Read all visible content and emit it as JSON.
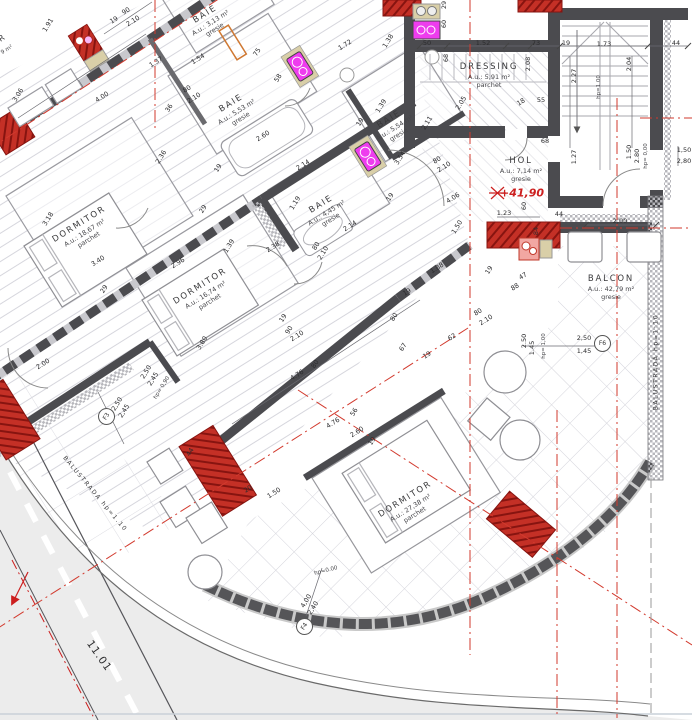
{
  "colors": {
    "wall": "#4b4b4f",
    "pier_red": "#c43026",
    "fixture_magenta": "#ee3cee",
    "fixture_beige": "#d9cfa8",
    "annotation_red": "#cc1f1f",
    "hatch": "#d6d6dd"
  },
  "rooms": [
    {
      "name": "DORMITOR",
      "area": "A.u.: 18,67 m²",
      "floor": "parchet",
      "x": 84,
      "y": 232,
      "r": -32
    },
    {
      "name": "DORMITOR",
      "area": "A.u.: 16,74 m²",
      "floor": "parchet",
      "x": 205,
      "y": 294,
      "r": -32
    },
    {
      "name": "DORMITOR",
      "area": "A.u.: 27,38 m²",
      "floor": "parchet",
      "x": 410,
      "y": 507,
      "r": -32
    },
    {
      "name": "BAIE",
      "area": "A.u.: 3,13 m²",
      "floor": "gresie",
      "x": 210,
      "y": 22,
      "r": -32
    },
    {
      "name": "BAIE",
      "area": "A.u.: 5,53 m²",
      "floor": "gresie",
      "x": 236,
      "y": 111,
      "r": -32
    },
    {
      "name": "BAIE",
      "area": "A.u.: 5,54 m²",
      "floor": "gresie",
      "x": 394,
      "y": 127,
      "r": -32
    },
    {
      "name": "BAIE",
      "area": "A.u.: 4,45 m²",
      "floor": "gresie",
      "x": 326,
      "y": 212,
      "r": -32
    },
    {
      "name": "DRESSING",
      "area": "A.u.: 5,91 m²",
      "floor": "parchet",
      "x": 489,
      "y": 76,
      "r": 0
    },
    {
      "name": "HOL",
      "area": "A.u.: 7,14 m²",
      "floor": "gresie",
      "x": 521,
      "y": 170,
      "r": 0
    },
    {
      "name": "BALCON",
      "area": "A.u.: 42,79 m²",
      "floor": "gresie",
      "x": 611,
      "y": 288,
      "r": 0
    }
  ],
  "window_tags": [
    {
      "id": "F3",
      "x": 106,
      "y": 416,
      "r": -58
    },
    {
      "id": "F4",
      "x": 304,
      "y": 626,
      "r": -58
    },
    {
      "id": "F6",
      "x": 602,
      "y": 343,
      "r": 0
    }
  ],
  "labels": [
    {
      "t": "1.91",
      "x": 48,
      "y": 25,
      "r": -58
    },
    {
      "t": "19",
      "x": 114,
      "y": 20,
      "r": -32
    },
    {
      "t": "90",
      "x": 126,
      "y": 11,
      "r": -32
    },
    {
      "t": "2.10",
      "x": 133,
      "y": 21,
      "r": -32
    },
    {
      "t": "1.37",
      "x": 156,
      "y": 62,
      "r": -32
    },
    {
      "t": "3.06",
      "x": 18,
      "y": 95,
      "r": -58
    },
    {
      "t": "4.00",
      "x": 102,
      "y": 97,
      "r": -32
    },
    {
      "t": "80",
      "x": 187,
      "y": 89,
      "r": -32
    },
    {
      "t": "2.10",
      "x": 194,
      "y": 98,
      "r": -32
    },
    {
      "t": "36",
      "x": 169,
      "y": 108,
      "r": -58
    },
    {
      "t": "2.36",
      "x": 161,
      "y": 157,
      "r": -58
    },
    {
      "t": "19",
      "x": 218,
      "y": 168,
      "r": -58
    },
    {
      "t": "29",
      "x": 203,
      "y": 209,
      "r": -58
    },
    {
      "t": "3.18",
      "x": 48,
      "y": 219,
      "r": -58
    },
    {
      "t": "3.40",
      "x": 98,
      "y": 261,
      "r": -32
    },
    {
      "t": "2.96",
      "x": 178,
      "y": 263,
      "r": -32
    },
    {
      "t": "1.39",
      "x": 229,
      "y": 246,
      "r": -58
    },
    {
      "t": "29",
      "x": 104,
      "y": 289,
      "r": -58
    },
    {
      "t": "2.00",
      "x": 43,
      "y": 364,
      "r": -32
    },
    {
      "t": "3.80",
      "x": 202,
      "y": 343,
      "r": -58
    },
    {
      "t": "1.54",
      "x": 198,
      "y": 59,
      "r": -32
    },
    {
      "t": "75",
      "x": 257,
      "y": 52,
      "r": -58
    },
    {
      "t": "58",
      "x": 278,
      "y": 78,
      "r": -58
    },
    {
      "t": "2.60",
      "x": 263,
      "y": 136,
      "r": -32
    },
    {
      "t": "1.72",
      "x": 345,
      "y": 45,
      "r": -32
    },
    {
      "t": "1.38",
      "x": 388,
      "y": 41,
      "r": -58
    },
    {
      "t": "1.39",
      "x": 381,
      "y": 106,
      "r": -58
    },
    {
      "t": "19",
      "x": 360,
      "y": 122,
      "r": -58
    },
    {
      "t": "2.14",
      "x": 303,
      "y": 165,
      "r": -32
    },
    {
      "t": "2.14",
      "x": 350,
      "y": 226,
      "r": -32
    },
    {
      "t": "2.38",
      "x": 273,
      "y": 247,
      "r": -32
    },
    {
      "t": "80",
      "x": 316,
      "y": 246,
      "r": -58
    },
    {
      "t": "2.10",
      "x": 323,
      "y": 253,
      "r": -58
    },
    {
      "t": "19",
      "x": 283,
      "y": 318,
      "r": -58
    },
    {
      "t": "90",
      "x": 289,
      "y": 330,
      "r": -58
    },
    {
      "t": "2.10",
      "x": 297,
      "y": 336,
      "r": -32
    },
    {
      "t": "1.88",
      "x": 437,
      "y": 268,
      "r": -32
    },
    {
      "t": "19",
      "x": 407,
      "y": 292,
      "r": -32
    },
    {
      "t": "80",
      "x": 394,
      "y": 317,
      "r": -58
    },
    {
      "t": "67",
      "x": 403,
      "y": 347,
      "r": -58
    },
    {
      "t": "19",
      "x": 427,
      "y": 355,
      "r": -32
    },
    {
      "t": "62",
      "x": 452,
      "y": 337,
      "r": -32
    },
    {
      "t": "88",
      "x": 515,
      "y": 287,
      "r": -32
    },
    {
      "t": "80",
      "x": 478,
      "y": 312,
      "r": -32
    },
    {
      "t": "2.10",
      "x": 486,
      "y": 320,
      "r": -32
    },
    {
      "t": "47",
      "x": 523,
      "y": 276,
      "r": -32
    },
    {
      "t": "19",
      "x": 489,
      "y": 270,
      "r": -58
    },
    {
      "t": "4.76",
      "x": 297,
      "y": 375,
      "r": -32
    },
    {
      "t": "80",
      "x": 315,
      "y": 364,
      "r": -58
    },
    {
      "t": "4.76",
      "x": 333,
      "y": 423,
      "r": -32
    },
    {
      "t": "56",
      "x": 354,
      "y": 412,
      "r": -58
    },
    {
      "t": "2.60",
      "x": 357,
      "y": 432,
      "r": -32
    },
    {
      "t": "19",
      "x": 372,
      "y": 441,
      "r": -58
    },
    {
      "t": "2.11",
      "x": 427,
      "y": 123,
      "r": -58
    },
    {
      "t": "2.05",
      "x": 461,
      "y": 103,
      "r": -58
    },
    {
      "t": "3.54",
      "x": 400,
      "y": 158,
      "r": -58
    },
    {
      "t": "80",
      "x": 437,
      "y": 160,
      "r": -32
    },
    {
      "t": "2.10",
      "x": 444,
      "y": 167,
      "r": -32
    },
    {
      "t": "19",
      "x": 390,
      "y": 197,
      "r": -58
    },
    {
      "t": "4.06",
      "x": 453,
      "y": 198,
      "r": -32
    },
    {
      "t": "1.50",
      "x": 457,
      "y": 227,
      "r": -58
    },
    {
      "t": "29",
      "x": 444,
      "y": 5,
      "r": -90
    },
    {
      "t": "60",
      "x": 444,
      "y": 24,
      "r": -90
    },
    {
      "t": "50",
      "x": 427,
      "y": 43,
      "r": 0
    },
    {
      "t": "1.52",
      "x": 483,
      "y": 43,
      "r": 0
    },
    {
      "t": "73",
      "x": 536,
      "y": 43,
      "r": 0
    },
    {
      "t": "19",
      "x": 566,
      "y": 43,
      "r": 0
    },
    {
      "t": "1.73",
      "x": 604,
      "y": 44,
      "r": 0
    },
    {
      "t": "44",
      "x": 676,
      "y": 43,
      "r": 0
    },
    {
      "t": "68",
      "x": 446,
      "y": 58,
      "r": -90
    },
    {
      "t": "2.08",
      "x": 528,
      "y": 64,
      "r": -90
    },
    {
      "t": "2.27",
      "x": 574,
      "y": 76,
      "r": -90
    },
    {
      "t": "2.04",
      "x": 629,
      "y": 64,
      "r": -90
    },
    {
      "t": "18",
      "x": 521,
      "y": 102,
      "r": -32
    },
    {
      "t": "55",
      "x": 541,
      "y": 100,
      "r": 0
    },
    {
      "t": "68",
      "x": 545,
      "y": 141,
      "r": 0
    },
    {
      "t": "1.27",
      "x": 574,
      "y": 157,
      "r": -90
    },
    {
      "t": "1.23",
      "x": 504,
      "y": 213,
      "r": 0
    },
    {
      "t": "60",
      "x": 524,
      "y": 206,
      "r": -90
    },
    {
      "t": "84",
      "x": 536,
      "y": 231,
      "r": -90
    },
    {
      "t": "44",
      "x": 559,
      "y": 214,
      "r": 0
    },
    {
      "t": "2,00",
      "x": 620,
      "y": 221,
      "r": 0
    },
    {
      "t": "20",
      "x": 248,
      "y": 489,
      "r": -32
    },
    {
      "t": "1.50",
      "x": 274,
      "y": 493,
      "r": -32
    },
    {
      "t": "44",
      "x": 190,
      "y": 452,
      "r": -58
    },
    {
      "t": "1.19",
      "x": 295,
      "y": 203,
      "r": -58
    },
    {
      "t": "R",
      "x": 2,
      "y": 38,
      "r": -32,
      "c": "rn"
    },
    {
      "t": "9 m²",
      "x": 7,
      "y": 50,
      "r": -32,
      "c": "s"
    },
    {
      "t": "2,50",
      "x": 146,
      "y": 372,
      "r": -58
    },
    {
      "t": "2,45",
      "x": 153,
      "y": 379,
      "r": -58
    },
    {
      "t": "hp= 0,90",
      "x": 162,
      "y": 388,
      "r": -58,
      "c": "s"
    },
    {
      "t": "2,50",
      "x": 117,
      "y": 404,
      "r": -58
    },
    {
      "t": "2,45",
      "x": 124,
      "y": 411,
      "r": -58
    },
    {
      "t": "4,00",
      "x": 306,
      "y": 601,
      "r": -58
    },
    {
      "t": "2,40",
      "x": 313,
      "y": 608,
      "r": -58
    },
    {
      "t": "2,50",
      "x": 584,
      "y": 338,
      "r": 0
    },
    {
      "t": "1,45",
      "x": 584,
      "y": 351,
      "r": 0
    },
    {
      "t": "2.50",
      "x": 524,
      "y": 341,
      "r": -90
    },
    {
      "t": "1.45",
      "x": 532,
      "y": 348,
      "r": -90
    },
    {
      "t": "hp= 1,00",
      "x": 544,
      "y": 346,
      "r": -90,
      "c": "s"
    },
    {
      "t": "1.50",
      "x": 629,
      "y": 152,
      "r": -90
    },
    {
      "t": "2.80",
      "x": 637,
      "y": 156,
      "r": -90
    },
    {
      "t": "hp= 0,00",
      "x": 646,
      "y": 156,
      "r": -90,
      "c": "s"
    },
    {
      "t": "hp=1.00",
      "x": 599,
      "y": 87,
      "r": -90,
      "c": "s"
    },
    {
      "t": "hp=0.00",
      "x": 326,
      "y": 571,
      "r": -14,
      "c": "s"
    },
    {
      "t": "1,50",
      "x": 684,
      "y": 150,
      "r": 0
    },
    {
      "t": "2,80",
      "x": 684,
      "y": 161,
      "r": 0
    },
    {
      "t": "+41,90",
      "x": 522,
      "y": 193,
      "r": 0,
      "c": "red"
    },
    {
      "t": "BALUSTRADĂ hp=1:10",
      "x": 656,
      "y": 362,
      "r": -90,
      "c": "bal"
    },
    {
      "t": "BALUSTRADA hp=1.10",
      "x": 95,
      "y": 494,
      "r": 50,
      "c": "bal"
    },
    {
      "t": "11.01",
      "x": 99,
      "y": 656,
      "r": 55,
      "c": "street"
    }
  ]
}
